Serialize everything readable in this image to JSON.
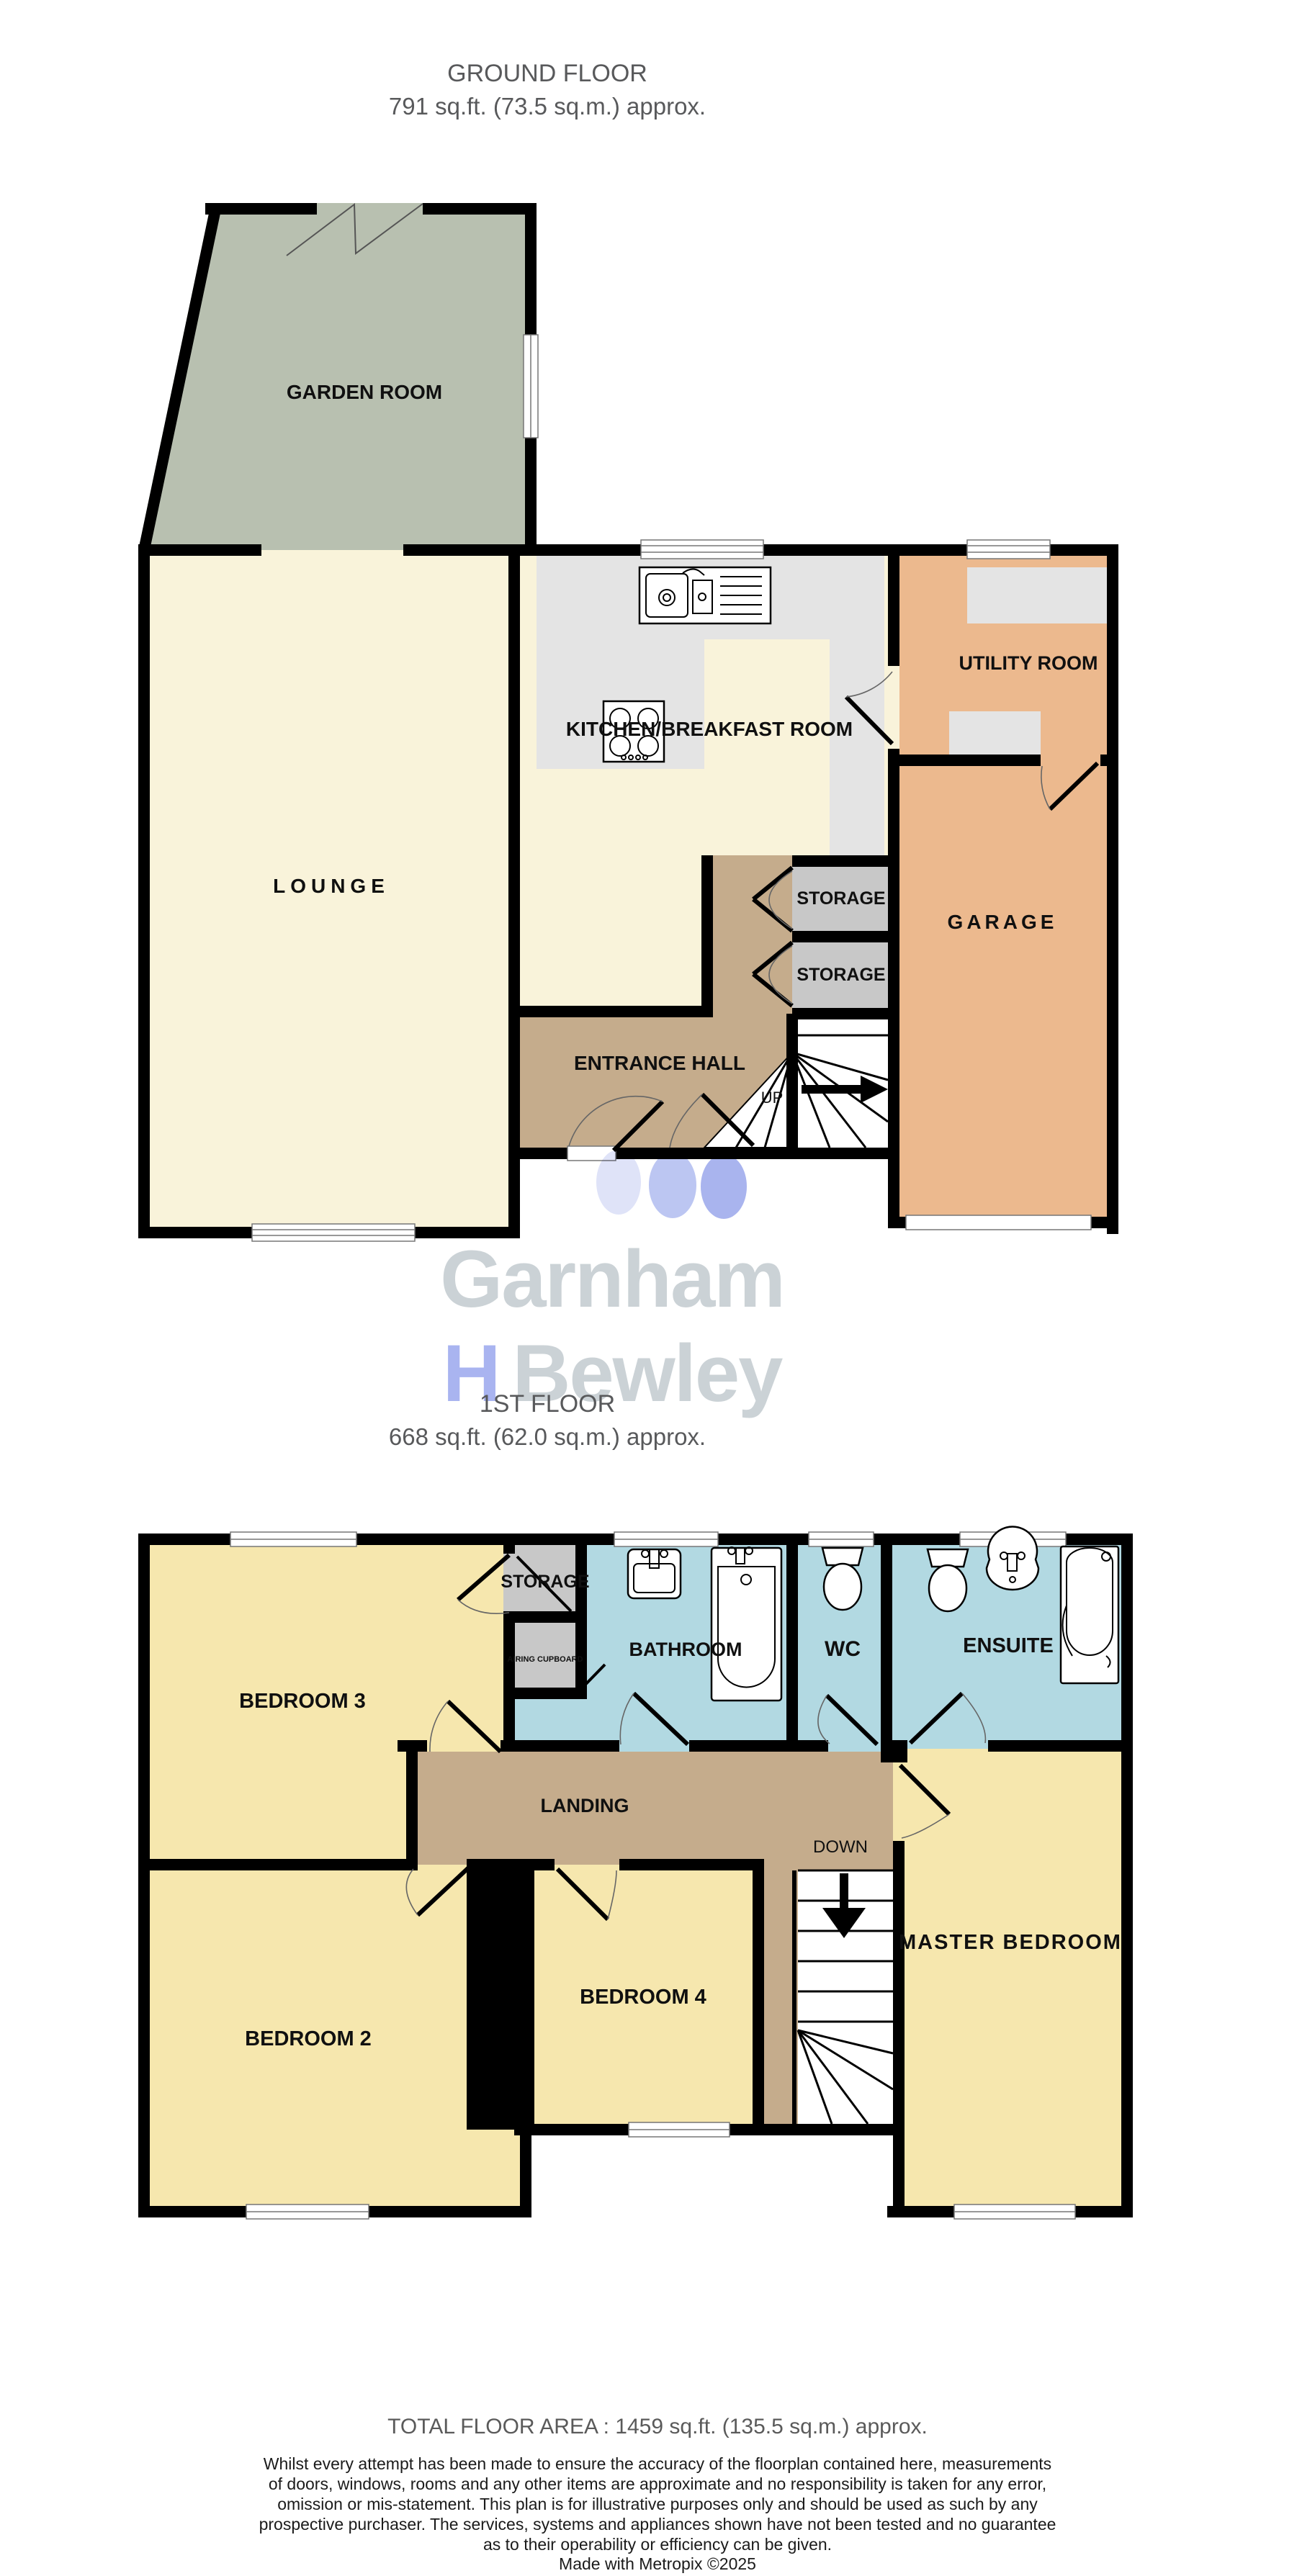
{
  "palette": {
    "wall": "#000000",
    "garden": "#b8c0b0",
    "cream": "#f9f3da",
    "counter": "#e4e4e4",
    "closet": "#c8c8c8",
    "tan": "#c5ac8c",
    "orange": "#ecb98e",
    "bedroom": "#f6e7ae",
    "bath": "#b2d9e2",
    "wm-gray": "#cbd2d6",
    "wm-blue": "#a9b4f0",
    "wm-dot1": "#dfe3f8",
    "wm-dot2": "#bcc6f2",
    "wm-dot3": "#a9b4ee"
  },
  "ground_floor": {
    "title": "GROUND FLOOR",
    "area": "791 sq.ft. (73.5 sq.m.) approx.",
    "rooms": {
      "garden_room": "GARDEN ROOM",
      "lounge": "LOUNGE",
      "kitchen": "KITCHEN/BREAKFAST ROOM",
      "utility": "UTILITY ROOM",
      "storage_1": "STORAGE",
      "storage_2": "STORAGE",
      "entrance_hall": "ENTRANCE HALL",
      "garage": "GARAGE",
      "up": "UP"
    }
  },
  "first_floor": {
    "title": "1ST FLOOR",
    "area": "668 sq.ft. (62.0 sq.m.) approx.",
    "rooms": {
      "bedroom_3": "BEDROOM 3",
      "storage": "STORAGE",
      "airing_cupboard": "AIRING CUPBOARD",
      "bathroom": "BATHROOM",
      "wc": "WC",
      "ensuite": "ENSUITE",
      "landing": "LANDING",
      "down": "DOWN",
      "bedroom_2": "BEDROOM 2",
      "bedroom_4": "BEDROOM 4",
      "master_bedroom": "MASTER BEDROOM"
    }
  },
  "watermark": {
    "line1": "Garnham",
    "line2_h": "H",
    "line2_rest": "Bewley"
  },
  "footer": {
    "total": "TOTAL FLOOR AREA : 1459 sq.ft. (135.5 sq.m.) approx.",
    "disclaimer_lines": [
      "Whilst every attempt has been made to ensure the accuracy of the floorplan contained here, measurements",
      "of doors, windows, rooms and any other items are approximate and no responsibility is taken for any error,",
      "omission or mis-statement. This plan is for illustrative purposes only and should be used as such by any",
      "prospective purchaser. The services, systems and appliances shown have not been tested and no guarantee",
      "as to their operability or efficiency can be given."
    ],
    "credit": "Made with Metropix ©2025"
  }
}
